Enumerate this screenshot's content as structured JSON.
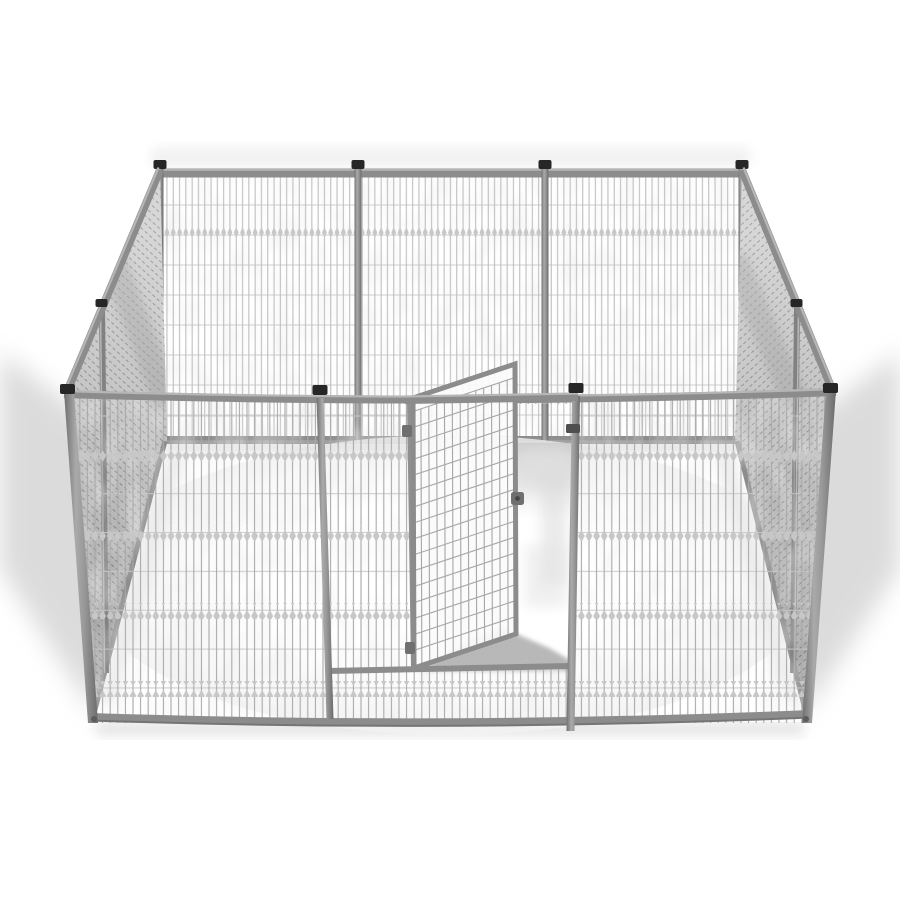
{
  "scene": {
    "title": "Heavy-duty welded wire dog kennel with open gate",
    "description": "3D product render on a white background of a square silver-gray welded-wire dog kennel / pet playpen. Mesh wall panels joined by tubular posts with black caps enclose the pen; the front gate door stands open, swung inward on two hinges, with a latch knob on its free edge and a strike plate on the latch post.",
    "background_color": "#ffffff"
  },
  "kennel": {
    "material": "welded steel wire mesh",
    "finish": "silver-gray",
    "walls": {
      "back_panels": 3,
      "left_panels": 2,
      "right_panels": 2,
      "front_sections": [
        "mesh panel",
        "gate section with door",
        "mesh panel"
      ]
    },
    "post_caps_visible": 10,
    "gate": {
      "state": "open",
      "swing": "inward",
      "hinge_side": "left",
      "hinge_count": 2,
      "latch": "slide latch with strike plate",
      "door_mesh_grid": "13 x 17 squares"
    }
  },
  "colors": {
    "background": "#ffffff",
    "frame": "#8c8c8c",
    "frame_highlight": "#b6b6b6",
    "frame_dark": "#757575",
    "post_cap": "#262626",
    "mesh_wire": "#a9a9a9",
    "mesh_wire_far": "#b9b9b9",
    "mesh_hwire": "#c9c9c9",
    "mesh_diamond": "#c7c7c7",
    "blotch": "#d9d9d9",
    "side_panel": "#c8c8c8",
    "side_stripe": "#787878",
    "side_fine_wire": "#cdcdcd",
    "hardware": "#6f6f6f",
    "floor": "#ffffff",
    "shadow_soft": "#ababab",
    "shadow_floor": "#b2b2b2",
    "shadow_under_wall": "#d8d8d8"
  }
}
